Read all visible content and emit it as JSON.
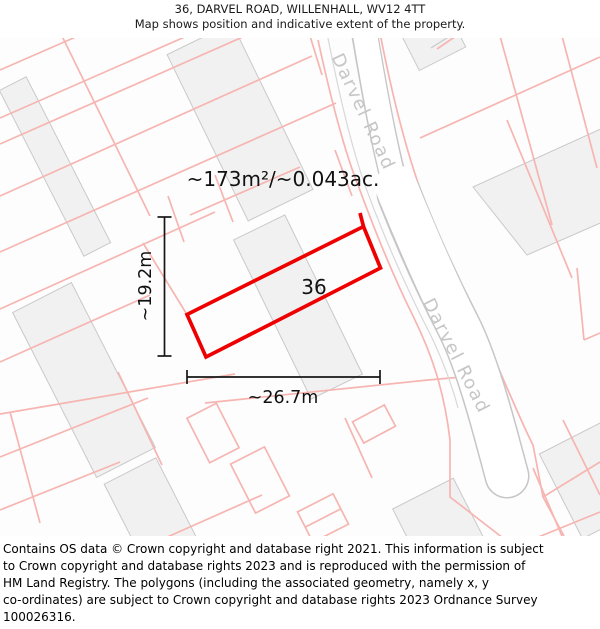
{
  "header": {
    "title": "36, DARVEL ROAD, WILLENHALL, WV12 4TT",
    "subtitle": "Map shows position and indicative extent of the property."
  },
  "map": {
    "road_name": "Darvel Road",
    "area_label": "~173m²/~0.043ac.",
    "plot_number": "36",
    "dim_height": "~19.2m",
    "dim_width": "~26.7m",
    "colors": {
      "plot_outline": "#ee0000",
      "parcel_line": "#f6b5b1",
      "building_fill": "#f1f1f1",
      "building_stroke": "#c9c9c9",
      "road_casing": "#c6c6c6",
      "road_fill": "#ffffff",
      "road_label": "#c6c6c6",
      "dimension_line": "#161616",
      "label_text": "#111111"
    }
  },
  "footer": {
    "lines": [
      "Contains OS data © Crown copyright and database right 2021. This information is subject",
      "to Crown copyright and database rights 2023 and is reproduced with the permission of",
      "HM Land Registry. The polygons (including the associated geometry, namely x, y",
      "co-ordinates) are subject to Crown copyright and database rights 2023 Ordnance Survey",
      "100026316."
    ]
  }
}
